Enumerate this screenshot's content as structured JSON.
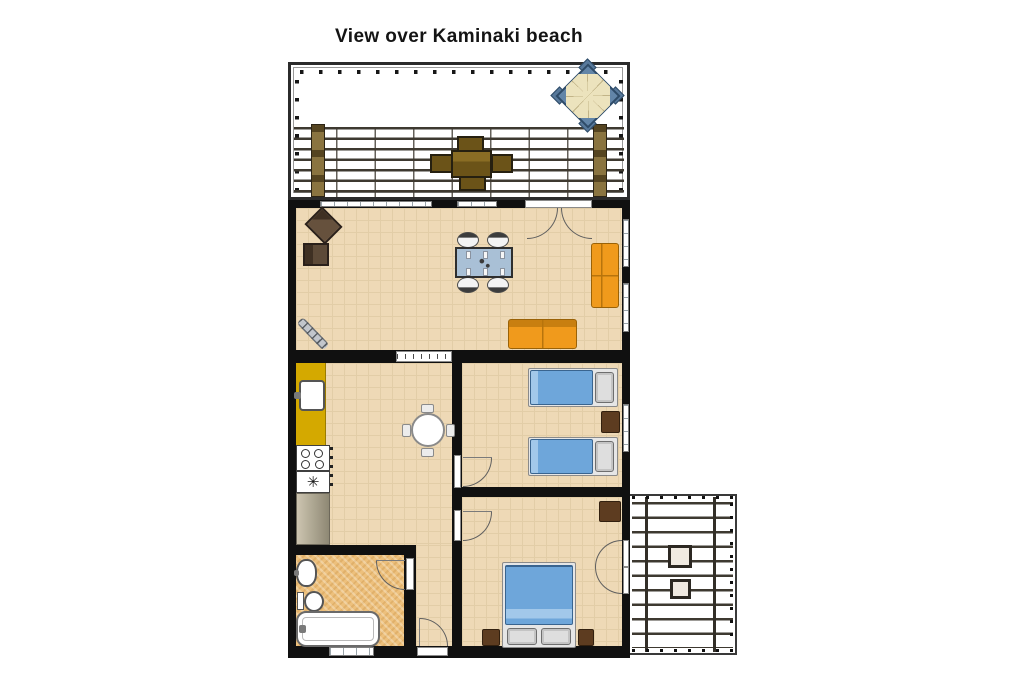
{
  "title": "View over Kaminaki beach",
  "labels": {
    "freezer_symbol": "✳"
  },
  "colors": {
    "wall": "#101010",
    "floor": "#eed9b6",
    "floor_line": "#e2cda7",
    "bath_floor": "#edc07c",
    "counter_yellow": "#d4a900",
    "sofa_orange": "#f09a1c",
    "bed_blue": "#6ea6da",
    "bed_blue_light": "#a2c8ea",
    "table_blue": "#a9c0d6",
    "wood_dark": "#4e3d2d",
    "wood_mid": "#6b5318",
    "nightstand_brown": "#5d3c20",
    "parasol_cream": "#ece3bd",
    "parasol_table_blue": "#6285a8",
    "pergola_line": "#3e3930",
    "post_brown": "#8a7440",
    "worktop_gray": "#b3ab96"
  }
}
